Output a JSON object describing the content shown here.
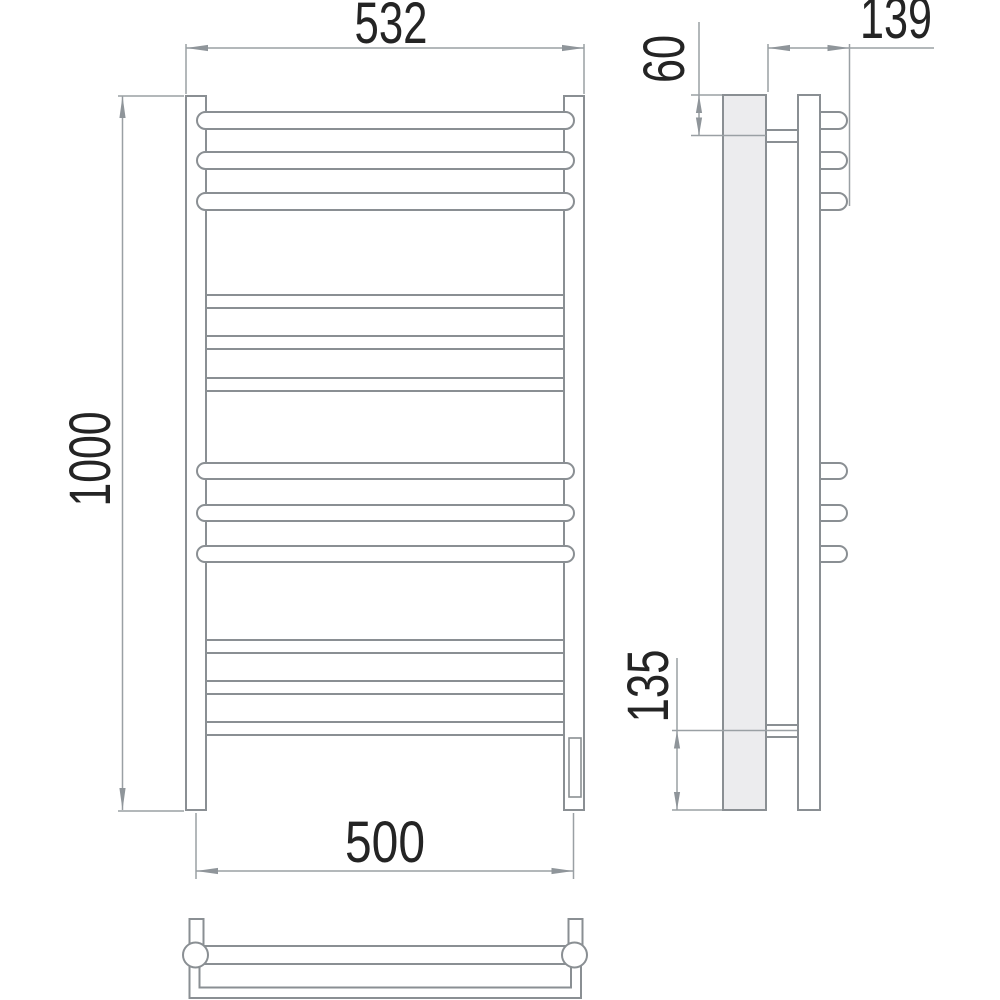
{
  "drawing": {
    "title": "towel-rail-technical-drawing",
    "colors": {
      "background": "#ffffff",
      "geometry_line": "#8a8f93",
      "dimension_line": "#9aa0a4",
      "text": "#242424",
      "side_plate_fill": "#ececee"
    },
    "front_view": {
      "overall_width_mm": "532",
      "overall_height_mm": "1000",
      "mounting_width_mm": "500",
      "rung_count": 12,
      "round_rung_count": 6,
      "flat_rung_count": 6
    },
    "side_view": {
      "top_bracket_offset_mm": "60",
      "overall_depth_mm": "139",
      "bottom_bracket_offset_mm": "135"
    }
  }
}
